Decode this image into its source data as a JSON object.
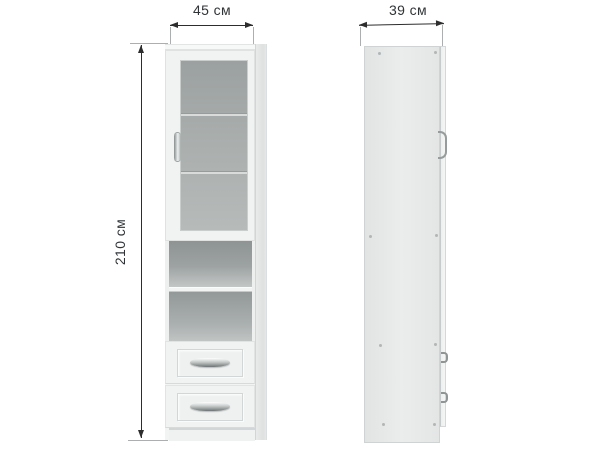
{
  "labels": {
    "width": "45 см",
    "depth": "39 см",
    "height": "210 см"
  },
  "values": {
    "width_cm": 45,
    "depth_cm": 39,
    "height_cm": 210,
    "unit": "см"
  },
  "views": {
    "front": {
      "glass_door_shelves": 2,
      "open_shelf_compartments": 2,
      "drawers": 2,
      "has_plinth": true
    },
    "side": {
      "screw_caps": 8,
      "protruding_handles": 3
    }
  },
  "icons": {
    "width_arrow": "double-headed horizontal arrow",
    "depth_arrow": "double-headed horizontal arrow",
    "height_arrow": "double-headed vertical arrow",
    "door_handle": "vertical metal bow handle",
    "drawer_handle": "curved metal bow handle",
    "screw_cap": "small gray dot"
  },
  "colors": {
    "background": "#ffffff",
    "dimension_line": "#2d2d2d",
    "extension_line": "#abafaf",
    "label_text": "#303436",
    "cabinet_white": "#f2f3f3",
    "glass_gray": "#a9aead",
    "interior_gray": "#9aa0a0",
    "side_panel_gray": "#e6e8e8",
    "metal_handle": "#8f9595"
  }
}
